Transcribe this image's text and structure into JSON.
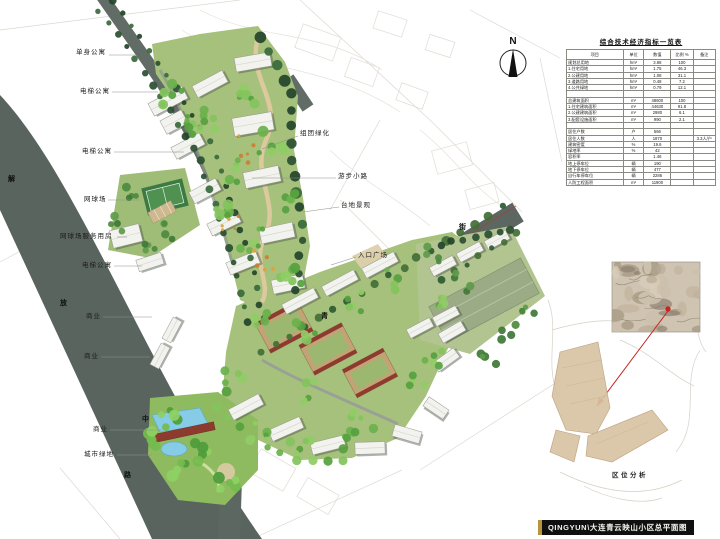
{
  "title_bar": {
    "text": "QINGYUN\\大连青云映山小区总平面图",
    "accent_color": "#b7953f",
    "bg_color": "#101010"
  },
  "north_arrow": {
    "label": "N"
  },
  "indicator_table": {
    "title": "综合技术经济指标一览表",
    "headers": [
      "项目",
      "单位",
      "数值",
      "比例 %",
      "备注"
    ],
    "rows": [
      [
        "规划总用地",
        "hm²",
        "3.98",
        "100",
        ""
      ],
      [
        "1.住宅用地",
        "hm²",
        "1.75",
        "46.3",
        ""
      ],
      [
        "2.公建用地",
        "hm²",
        "1.08",
        "31.1",
        ""
      ],
      [
        "3.道路用地",
        "hm²",
        "0.48",
        "7.2",
        ""
      ],
      [
        "4.公共绿地",
        "hm²",
        "0.79",
        "12.1",
        ""
      ],
      [
        "",
        "",
        "",
        "",
        ""
      ],
      [
        "总建筑面积",
        "m²",
        "48600",
        "100",
        ""
      ],
      [
        "1.住宅建筑面积",
        "m²",
        "44630",
        "91.8",
        ""
      ],
      [
        "2.公建建筑面积",
        "m²",
        "2980",
        "6.1",
        ""
      ],
      [
        "3.配套设施面积",
        "m²",
        "990",
        "2.1",
        ""
      ],
      [
        "",
        "",
        "",
        "",
        ""
      ],
      [
        "居住户数",
        "户",
        "566",
        "",
        ""
      ],
      [
        "居住人数",
        "人",
        "1870",
        "",
        "3.3人/户"
      ],
      [
        "建筑密度",
        "%",
        "19.6",
        "",
        ""
      ],
      [
        "绿地率",
        "%",
        "42",
        "",
        ""
      ],
      [
        "容积率",
        "",
        "1.46",
        "",
        ""
      ],
      [
        "地上停车位",
        "辆",
        "190",
        "",
        ""
      ],
      [
        "地下停车位",
        "辆",
        "477",
        "",
        ""
      ],
      [
        "自行车停车位",
        "辆",
        "2286",
        "",
        ""
      ],
      [
        "人防工程面积",
        "m²",
        "11900",
        "",
        ""
      ]
    ]
  },
  "plan_labels": [
    {
      "text": "单身公寓",
      "x": 76,
      "y": 49
    },
    {
      "text": "电梯公寓",
      "x": 80,
      "y": 88
    },
    {
      "text": "电梯公寓",
      "x": 82,
      "y": 148
    },
    {
      "text": "网球场",
      "x": 84,
      "y": 196
    },
    {
      "text": "网球场服务用房",
      "x": 60,
      "y": 233
    },
    {
      "text": "电梯公寓",
      "x": 82,
      "y": 262
    },
    {
      "text": "商业",
      "x": 86,
      "y": 313
    },
    {
      "text": "商业",
      "x": 84,
      "y": 353
    },
    {
      "text": "商业",
      "x": 93,
      "y": 426
    },
    {
      "text": "城市绿地",
      "x": 84,
      "y": 451
    },
    {
      "text": "组团绿化",
      "x": 300,
      "y": 130
    },
    {
      "text": "游步小路",
      "x": 338,
      "y": 173
    },
    {
      "text": "台地景观",
      "x": 341,
      "y": 202
    },
    {
      "text": "入口广场",
      "x": 358,
      "y": 252
    }
  ],
  "road_names": [
    {
      "text": "解",
      "x": 8,
      "y": 176
    },
    {
      "text": "放",
      "x": 60,
      "y": 300
    },
    {
      "text": "中",
      "x": 142,
      "y": 416
    },
    {
      "text": "路",
      "x": 124,
      "y": 472
    },
    {
      "text": "青",
      "x": 321,
      "y": 313
    },
    {
      "text": "街",
      "x": 459,
      "y": 224
    }
  ],
  "inset": {
    "caption": "区位分析",
    "marker_color": "#d01f1f"
  },
  "colors": {
    "road": "#59645f",
    "cluster_green": "#a6c17b",
    "tree_dark": "#2c5031",
    "tree_bright": "#6ab24c",
    "path_tan": "#dcc99e",
    "building_white": "#f2f2ee",
    "courtyard_tan": "#c3a376",
    "roof_red": "#8e3b2f",
    "pool_blue": "#86cce6",
    "slab_green": "#9aab85",
    "parcel_tan": "#d9c3a2"
  }
}
